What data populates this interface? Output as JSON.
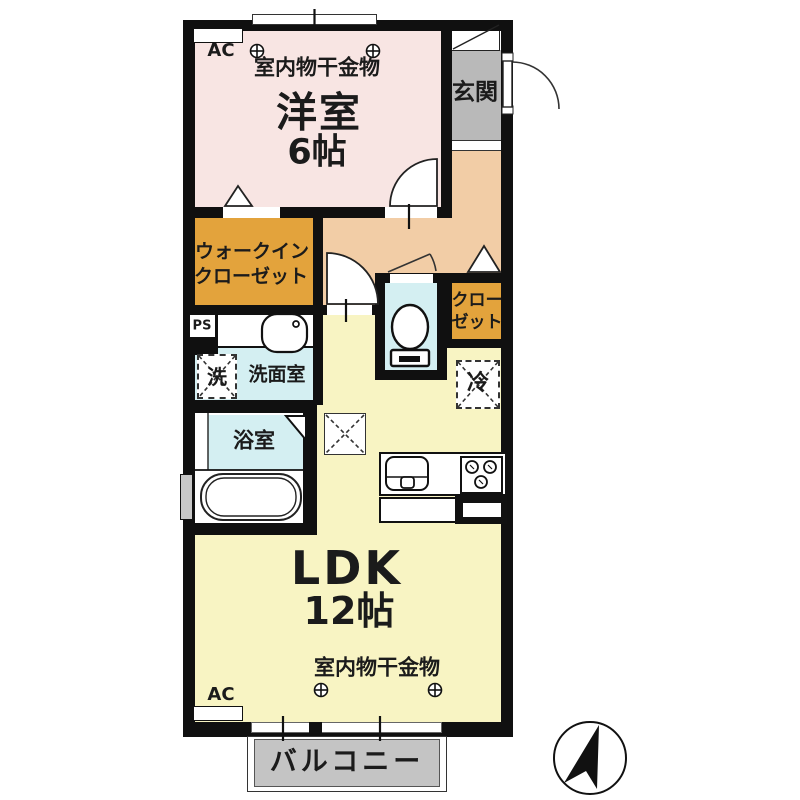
{
  "plan": {
    "title": "1LDK apartment floor plan",
    "rooms": {
      "western_room": {
        "name": "洋室",
        "size": "6帖"
      },
      "entrance": {
        "name": "玄関"
      },
      "walk_in_closet": {
        "line1": "ウォークイン",
        "line2": "クローゼット"
      },
      "closet": {
        "line1": "クロー",
        "line2": "ゼット"
      },
      "washroom": {
        "name": "洗面室"
      },
      "bathroom": {
        "name": "浴室"
      },
      "ldk": {
        "name": "LDK",
        "size": "12帖"
      },
      "balcony": {
        "name": "バルコニー"
      }
    },
    "equipment": {
      "indoor_laundry_hanger": "室内物干金物",
      "air_conditioner": "AC",
      "pipe_space": "PS",
      "washing_machine": "洗",
      "refrigerator": "冷"
    },
    "icons": {
      "laundry_hook": "⊕",
      "north_arrow": "filled needle in circle, pointing up",
      "door_swing": "quarter-circle arc",
      "folding_door": "triangle marker",
      "pillar_or_hatch": "square with dashed X"
    },
    "colors": {
      "wall": "#101010",
      "western_room": "#f8e5e3",
      "hall": "#f2cda6",
      "closet": "#e3a33c",
      "wet_area": "#d4eff2",
      "ldk": "#f8f4c3",
      "entrance_gray": "#b9b9b9",
      "balcony_gray": "#c4c4c4",
      "window_gray": "#c8c8c8",
      "text": "#1b1b1b"
    }
  }
}
